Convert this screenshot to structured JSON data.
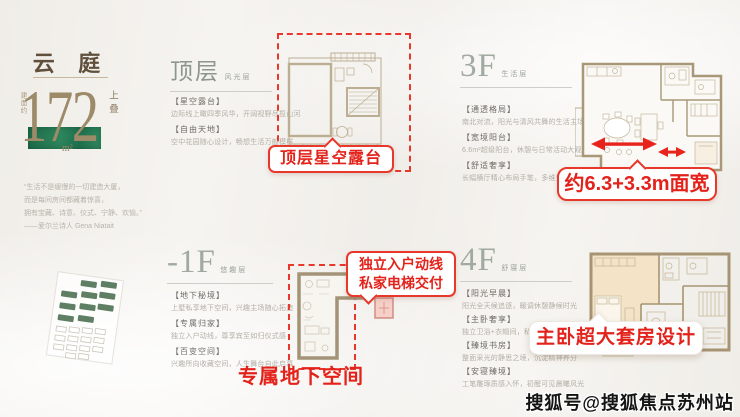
{
  "hero": {
    "title": "云 庭",
    "area": {
      "prefix": "建面约",
      "number": "172",
      "unit": "m²",
      "suffix": "上叠"
    },
    "quote_lines": [
      "“生活不是缓慢的一切建造大厦，",
      "而是每间房间都藏着惊喜，",
      "拥有宝藏、诗意、仪式、宁静、欢愉。”",
      "——爱尔兰诗人 Gena Niatait"
    ]
  },
  "sections": {
    "top_floor": {
      "title": "顶层",
      "subtitle": "风光层",
      "items": [
        {
          "label": "【星空露台】",
          "desc": "边际线上瞰四季风华，开阔视野尽揽山河"
        },
        {
          "label": "【自由天地】",
          "desc": "空中花园随心设计，畅想生活万般模样"
        }
      ]
    },
    "minus_1f": {
      "title": "-1F",
      "subtitle": "悠趣层",
      "items": [
        {
          "label": "【地下秘境】",
          "desc": "上墅私享地下空间，兴趣主场随心拓造"
        },
        {
          "label": "【专属归家】",
          "desc": "独立入户动线，尊享宾至如归仪式感"
        },
        {
          "label": "【百变空间】",
          "desc": "兴趣所向收藏空间，人生舞台自此启幕"
        }
      ]
    },
    "f3": {
      "title": "3F",
      "subtitle": "生活层",
      "items": [
        {
          "label": "【通透格局】",
          "desc": "南北对流，阳光与清风共舞的生活主场"
        },
        {
          "label": "【宽境阳台】",
          "desc": "6.6m²超级阳台，休憩与日常活动大观"
        },
        {
          "label": "【舒适奢享】",
          "desc": "长幅横厅精心布局手笔，多维生活模式切换"
        }
      ]
    },
    "f4": {
      "title": "4F",
      "subtitle": "舒寝层",
      "items": [
        {
          "label": "【阳光早晨】",
          "desc": "阳光全天候追逐，暖调休憩静候时光"
        },
        {
          "label": "【主卧奢享】",
          "desc": "独立卫浴+衣帽间，私属格局不负晨昏"
        },
        {
          "label": "【臻境书房】",
          "desc": "整面采光的静思之境，沉淀精神养分"
        },
        {
          "label": "【安寝臻境】",
          "desc": "工笔雕琢质感入怀，初醒可见晨曦风光"
        }
      ]
    }
  },
  "callouts": {
    "rooftop_terrace": "顶层星空露台",
    "private_entry_line1": "独立入户动线",
    "private_entry_line2": "私家电梯交付",
    "basement_space": "专属地下空间",
    "bay_width": "约6.3+3.3m面宽",
    "master_suite": "主卧超大套房设计"
  },
  "colors": {
    "accent_red": "#e8382c",
    "brand_green": "#2a7a55",
    "bronze": "#9c8a68"
  },
  "watermark": "搜狐号@搜狐焦点苏州站"
}
